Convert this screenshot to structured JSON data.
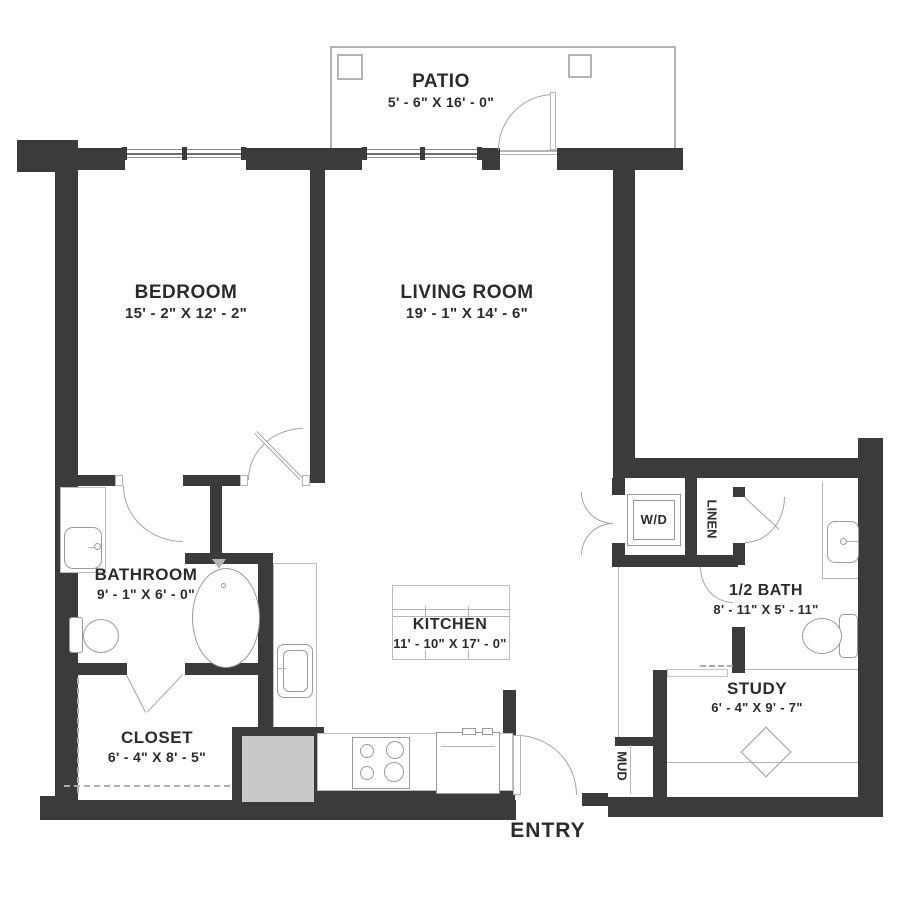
{
  "floor_plan": {
    "rooms": {
      "patio": {
        "name": "PATIO",
        "dims": "5' - 6\" X 16' - 0\""
      },
      "bedroom": {
        "name": "BEDROOM",
        "dims": "15' - 2\" X 12' - 2\""
      },
      "living_room": {
        "name": "LIVING ROOM",
        "dims": "19' - 1\" X 14' - 6\""
      },
      "bathroom": {
        "name": "BATHROOM",
        "dims": "9' - 1\" X 6' - 0\""
      },
      "kitchen": {
        "name": "KITCHEN",
        "dims": "11' - 10\" X 17' - 0\""
      },
      "closet": {
        "name": "CLOSET",
        "dims": "6' - 4\" X 8' - 5\""
      },
      "half_bath": {
        "name": "1/2 BATH",
        "dims": "8' - 11\" X 5' - 11\""
      },
      "study": {
        "name": "STUDY",
        "dims": "6' - 4\" X 9' - 7\""
      },
      "wd": {
        "name": "W/D"
      },
      "linen": {
        "name": "LINEN"
      },
      "mud": {
        "name": "MUD"
      },
      "entry": {
        "name": "ENTRY"
      }
    },
    "colors": {
      "wall": "#3b3b3c",
      "line": "#a3a3a3",
      "appliance_fill": "#c9c9c9",
      "text": "#2b2b2d",
      "background": "#ffffff"
    }
  }
}
